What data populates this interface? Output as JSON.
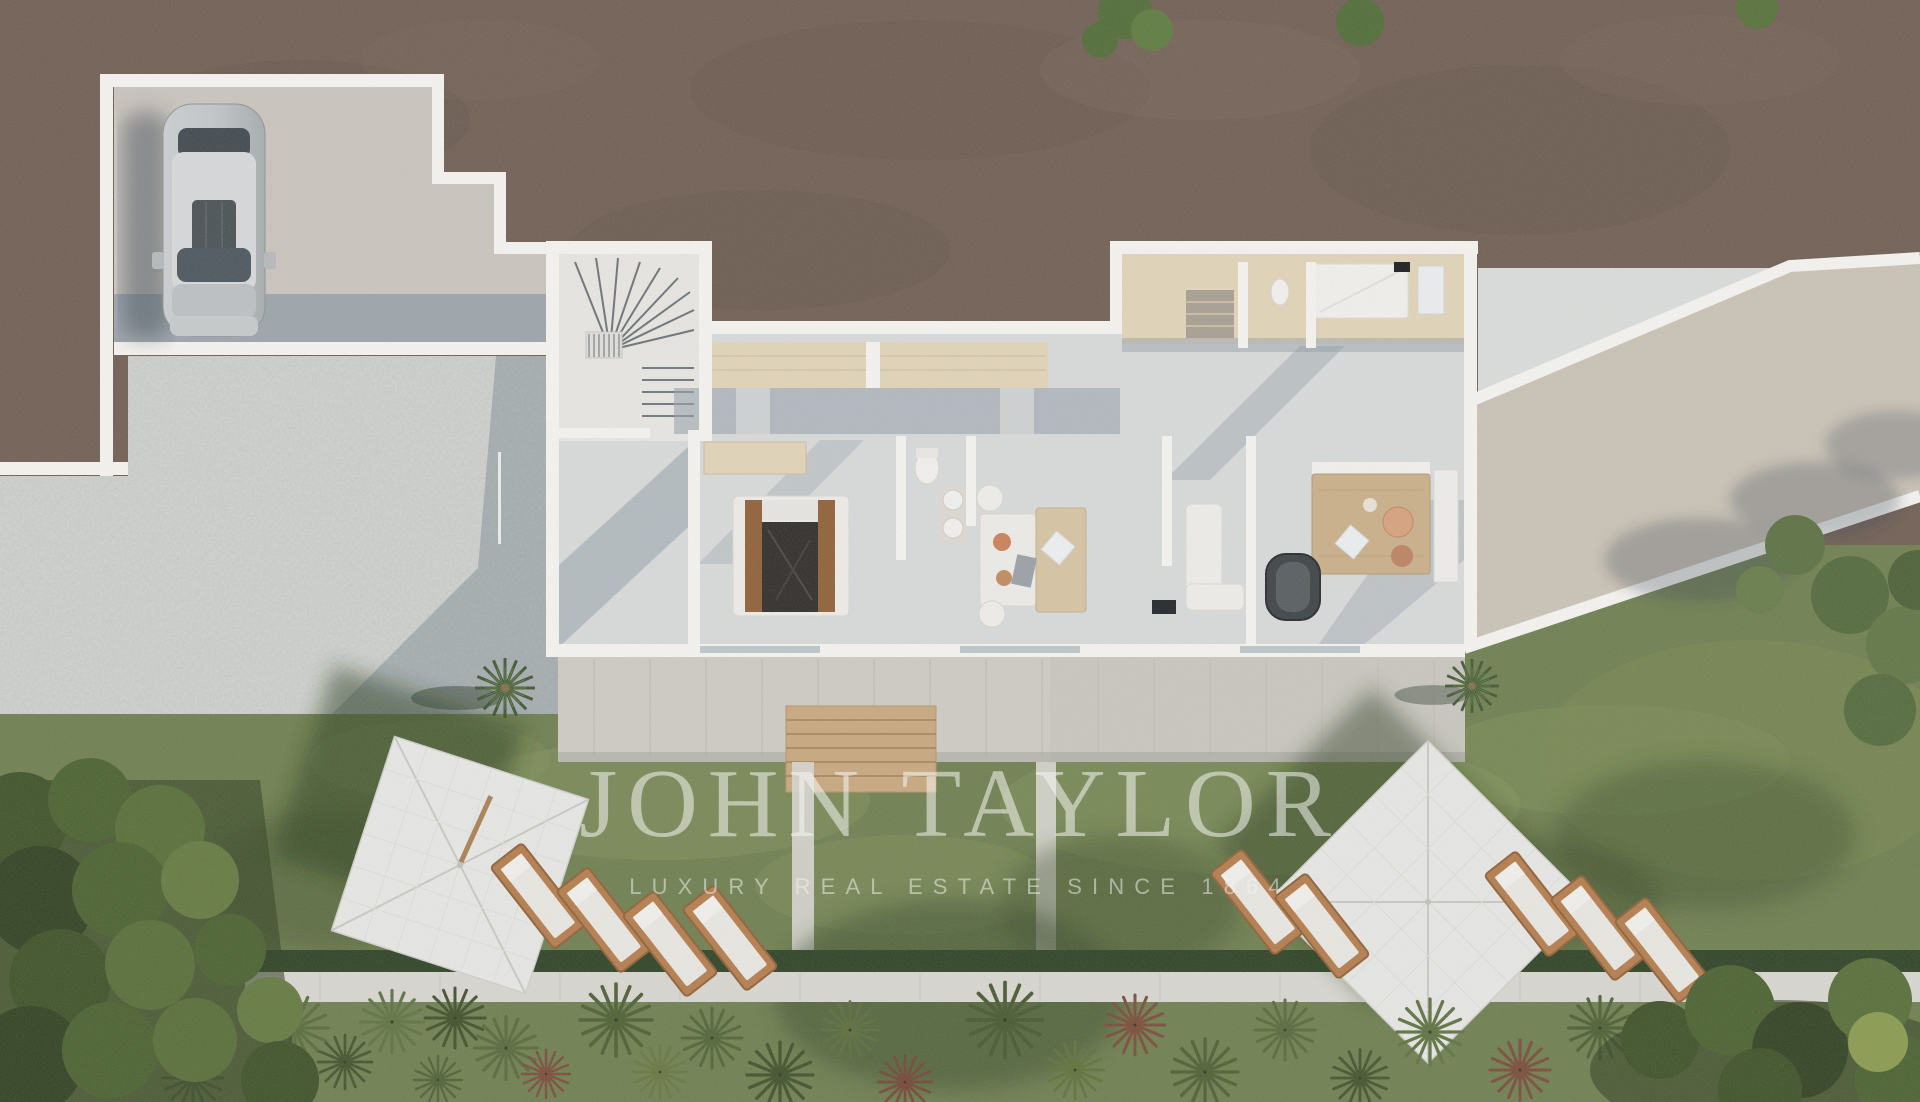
{
  "watermark": {
    "title": "JOHN TAYLOR",
    "subtitle": "LUXURY REAL ESTATE SINCE 1864"
  },
  "scene": {
    "type": "aerial-3d-floor-plan-render",
    "areas": [
      "walled parking court with one silver car",
      "gravel courtyard",
      "villa wing with winder staircase, two bedrooms, bathrooms and lounge",
      "upper service wing with travertine floors",
      "long sun terrace with two small palms",
      "wooden deck steps to lawn",
      "two square white parasols with wooden sun loungers",
      "white garden walkway with hedge",
      "garden of fan palms and trees"
    ],
    "sun_loungers": {
      "left_group": 4,
      "right_group": 5
    }
  },
  "colors": {
    "dirt": "#6f5d52",
    "grass": "#6e7e4e",
    "grass_shadow": "#394929",
    "gravel": "#c6c8c5",
    "wall": "#f7f6f3",
    "floor": "#dadcdc",
    "floor_shadow": "#939fa9",
    "travertine": "#e3d5b8",
    "terrace": "#cfccc5",
    "concrete_terrace": "#cbc3b6",
    "deck": "#c9a87e",
    "hedge": "#2c4123",
    "path": "#d9d8d2",
    "canopy": "#e9e9e7",
    "wood": "#8f5f36",
    "car_body": "#c3c6c9",
    "bed_dark": "#2d2a28",
    "watermark_text": "rgba(244,246,243,0.55)"
  }
}
